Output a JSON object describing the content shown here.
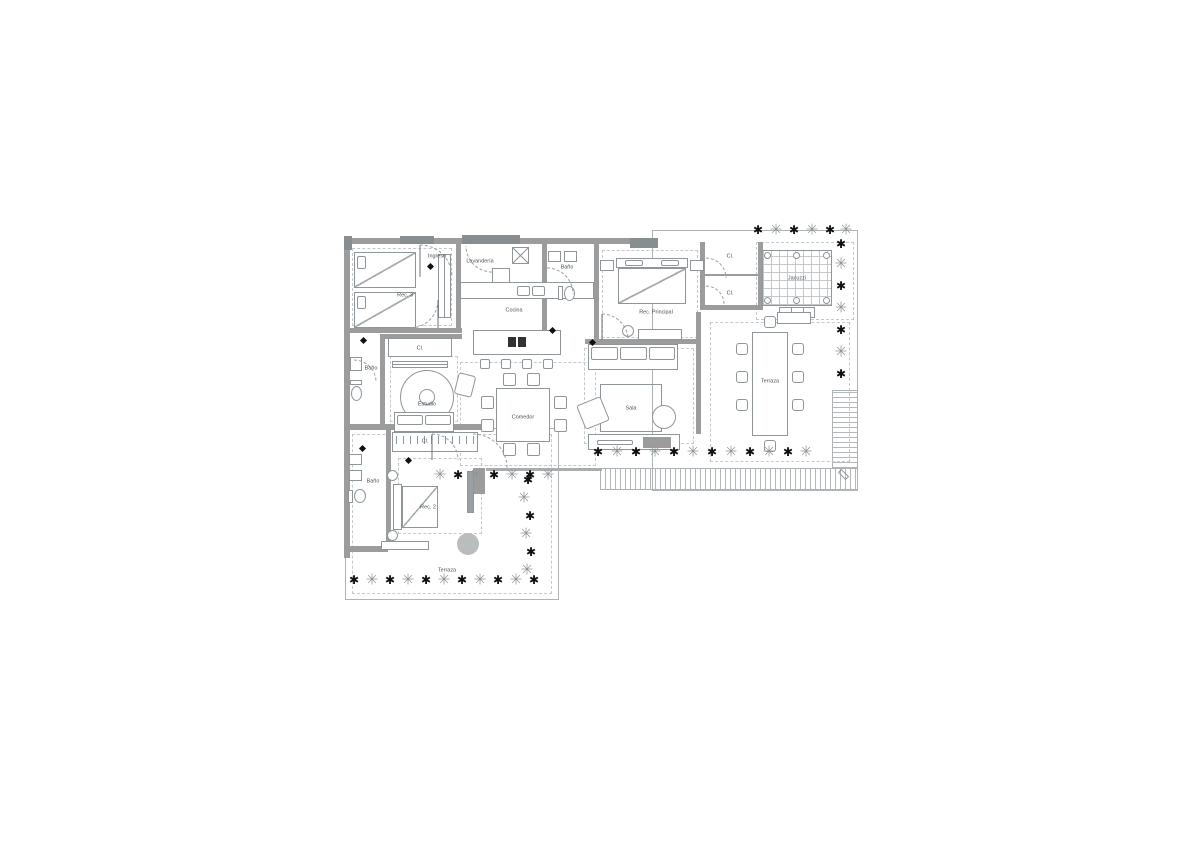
{
  "title": "Apartment floor plan",
  "palette": {
    "line": "#8f9699",
    "wall": "#9c9c9c",
    "walld": "#888d8f",
    "dash": "#c5c9cb",
    "deck": "#b3b8ba",
    "fillg": "#b9bdbd",
    "ink": "#4a4f52",
    "plant_dark": "#101010",
    "plant_light": "#8f9699"
  },
  "icons": {
    "plant_dark_glyph": "✱",
    "plant_light_glyph": "✳"
  },
  "rooms": [
    {
      "id": "rec3",
      "label": "Rec. 3",
      "x": 65,
      "y": 67
    },
    {
      "id": "ingreso",
      "label": "Ingreso",
      "x": 97,
      "y": 28
    },
    {
      "id": "lavanderia",
      "label": "Lavandería",
      "x": 140,
      "y": 33
    },
    {
      "id": "bano-top",
      "label": "Baño",
      "x": 227,
      "y": 39
    },
    {
      "id": "cocina",
      "label": "Cocina",
      "x": 174,
      "y": 82
    },
    {
      "id": "cl-estudio",
      "label": "Cl.",
      "x": 80,
      "y": 120
    },
    {
      "id": "bano-mid",
      "label": "Baño",
      "x": 31,
      "y": 140
    },
    {
      "id": "estudio",
      "label": "Estudio",
      "x": 87,
      "y": 176
    },
    {
      "id": "comedor",
      "label": "Comedor",
      "x": 183,
      "y": 189
    },
    {
      "id": "sala",
      "label": "Sala",
      "x": 291,
      "y": 180
    },
    {
      "id": "rec-principal",
      "label": "Rec. Principal",
      "x": 316,
      "y": 84
    },
    {
      "id": "cl-master-1",
      "label": "Cl.",
      "x": 390,
      "y": 28
    },
    {
      "id": "cl-master-2",
      "label": "Cl.",
      "x": 390,
      "y": 65
    },
    {
      "id": "jacuzzi",
      "label": "Jacuzzi",
      "x": 457,
      "y": 50
    },
    {
      "id": "terraza-right",
      "label": "Terraza",
      "x": 430,
      "y": 153
    },
    {
      "id": "cl-rec2",
      "label": "Cl.",
      "x": 85,
      "y": 213
    },
    {
      "id": "bano-low",
      "label": "Baño",
      "x": 33,
      "y": 253
    },
    {
      "id": "rec2",
      "label": "Rec. 2",
      "x": 88,
      "y": 279
    },
    {
      "id": "terraza-bottom",
      "label": "Terraza",
      "x": 107,
      "y": 342
    }
  ],
  "decor": {
    "plants": [
      [
        418,
        2,
        "d"
      ],
      [
        436,
        2,
        "l"
      ],
      [
        454,
        2,
        "d"
      ],
      [
        472,
        2,
        "l"
      ],
      [
        490,
        2,
        "d"
      ],
      [
        506,
        2,
        "l"
      ],
      [
        501,
        16,
        "d"
      ],
      [
        501,
        36,
        "l"
      ],
      [
        501,
        58,
        "d"
      ],
      [
        501,
        80,
        "l"
      ],
      [
        501,
        102,
        "d"
      ],
      [
        501,
        124,
        "l"
      ],
      [
        501,
        146,
        "d"
      ],
      [
        258,
        224,
        "d"
      ],
      [
        277,
        224,
        "l"
      ],
      [
        296,
        224,
        "d"
      ],
      [
        315,
        224,
        "l"
      ],
      [
        334,
        224,
        "d"
      ],
      [
        353,
        224,
        "l"
      ],
      [
        372,
        224,
        "d"
      ],
      [
        391,
        224,
        "l"
      ],
      [
        410,
        224,
        "d"
      ],
      [
        429,
        224,
        "l"
      ],
      [
        448,
        224,
        "d"
      ],
      [
        466,
        224,
        "l"
      ],
      [
        100,
        247,
        "l"
      ],
      [
        118,
        247,
        "d"
      ],
      [
        136,
        247,
        "l"
      ],
      [
        154,
        247,
        "d"
      ],
      [
        172,
        247,
        "l"
      ],
      [
        190,
        247,
        "d"
      ],
      [
        208,
        247,
        "l"
      ],
      [
        188,
        252,
        "d"
      ],
      [
        184,
        270,
        "l"
      ],
      [
        190,
        288,
        "d"
      ],
      [
        186,
        306,
        "l"
      ],
      [
        191,
        324,
        "d"
      ],
      [
        187,
        342,
        "l"
      ],
      [
        14,
        352,
        "d"
      ],
      [
        32,
        352,
        "l"
      ],
      [
        50,
        352,
        "d"
      ],
      [
        68,
        352,
        "l"
      ],
      [
        86,
        352,
        "d"
      ],
      [
        104,
        352,
        "l"
      ],
      [
        122,
        352,
        "d"
      ],
      [
        140,
        352,
        "l"
      ],
      [
        158,
        352,
        "d"
      ],
      [
        176,
        352,
        "l"
      ],
      [
        194,
        352,
        "d"
      ]
    ]
  }
}
